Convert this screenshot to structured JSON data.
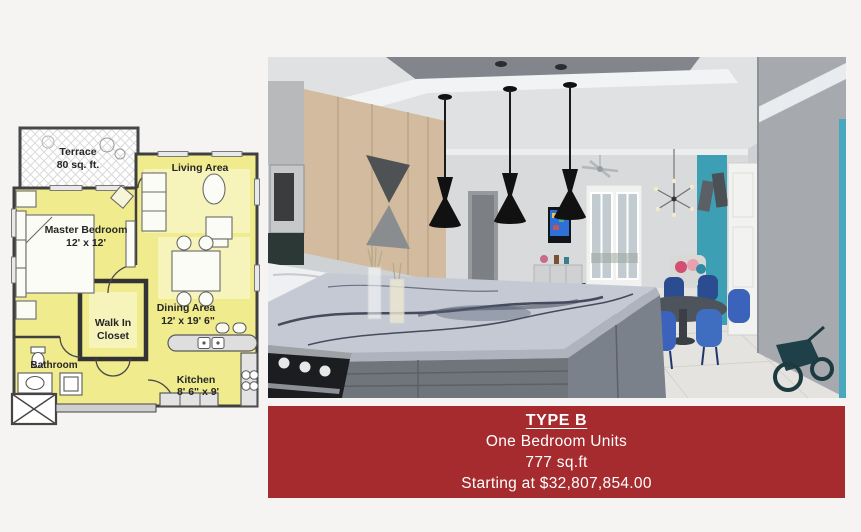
{
  "page": {
    "background": "#f5f4f2"
  },
  "colors": {
    "banner_red": "#a52b2f",
    "plan_yellow": "#f0eb8d",
    "plan_pale_yellow": "#f6f3bb",
    "accent_teal": "#3d9fb4",
    "chair_blue": "#3b63bb"
  },
  "floor_plan": {
    "terrace": {
      "name": "Terrace",
      "dims": "80 sq. ft."
    },
    "living": {
      "name": "Living Area"
    },
    "master_bedroom": {
      "name": "Master Bedroom",
      "dims": "12' x 12'"
    },
    "walk_in_closet": {
      "line1": "Walk In",
      "line2": "Closet"
    },
    "dining": {
      "name": "Dining Area",
      "dims": "12' x 19' 6\""
    },
    "bathroom": {
      "name": "Bathroom"
    },
    "kitchen": {
      "name": "Kitchen",
      "dims": "8' 6\" x 9'"
    }
  },
  "unit_card": {
    "type_label": "TYPE B",
    "description": "One Bedroom Units",
    "area": "777 sq.ft",
    "price": "Starting at $32,807,854.00"
  }
}
